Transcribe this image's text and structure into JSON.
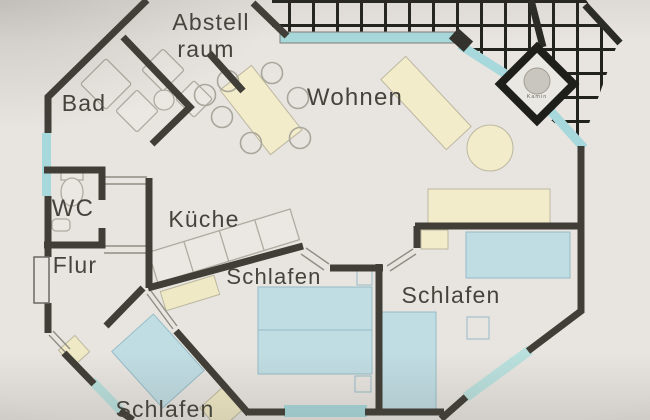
{
  "plan": {
    "rooms": {
      "abstellraum": {
        "line1": "Abstell",
        "line2": "raum"
      },
      "bad": "Bad",
      "wc": "WC",
      "flur": "Flur",
      "kueche": "Küche",
      "wohnen": "Wohnen",
      "schlafen_mitte": "Schlafen",
      "schlafen_rechts": "Schlafen",
      "schlafen_unten": "Schlafen",
      "kamin": "Kamin"
    },
    "colors": {
      "paper": "#e8e5e1",
      "wall": "#403e37",
      "window_glass": "#a7d8db",
      "furniture_beige": "#f2ecca",
      "furniture_blue": "#c0dde3",
      "pergola_grid": "#23231e",
      "thin_line": "#908d84"
    }
  }
}
